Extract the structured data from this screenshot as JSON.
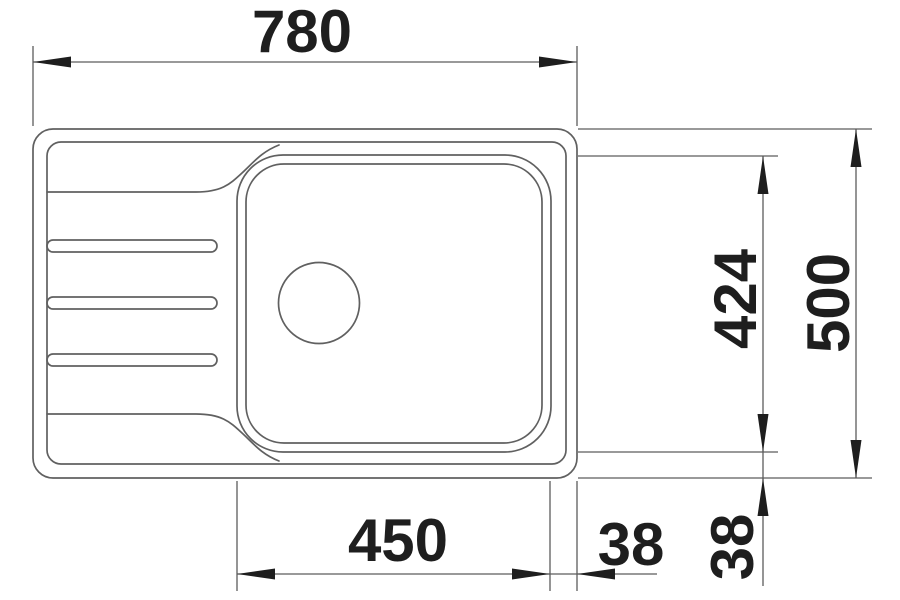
{
  "colors": {
    "background": "#ffffff",
    "outline": "#606060",
    "dimension_line": "#5c5c5c",
    "text": "#1e1e1e"
  },
  "dimensions": {
    "overall_width": "780",
    "overall_depth": "500",
    "bowl_inner_depth": "424",
    "bowl_width": "450",
    "bowl_right_offset": "38",
    "bowl_bottom_offset": "38"
  }
}
